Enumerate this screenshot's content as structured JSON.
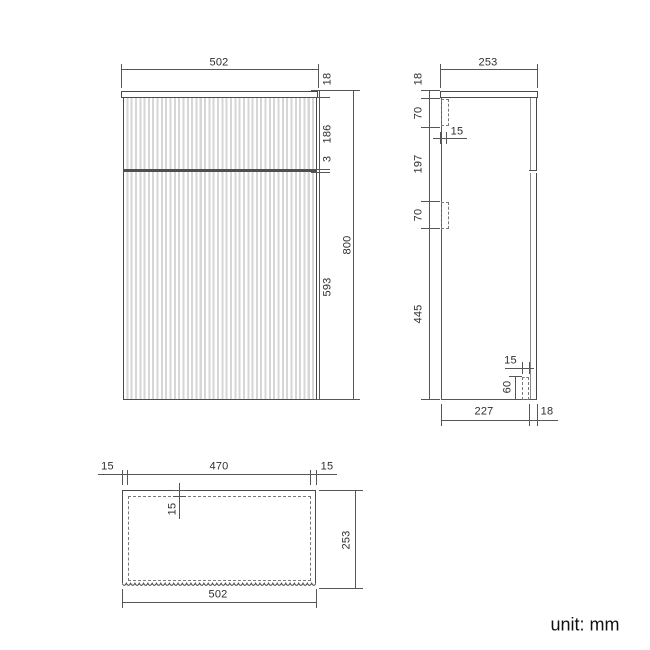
{
  "drawing": {
    "front_view": {
      "width": "502",
      "top_thickness": "18",
      "drawer_front_height": "186",
      "panel_gap": "3",
      "overall_height": "800",
      "lower_front_height": "593"
    },
    "side_view": {
      "depth": "253",
      "top_thickness": "18",
      "upper_bracket_height": "70",
      "bracket_thickness": "15",
      "bracket_spacing": "197",
      "middle_bracket_height": "70",
      "lower_section_height": "445",
      "bottom_bracket_thickness": "15",
      "bottom_bracket_height": "60",
      "base_depth": "227",
      "front_panel_thickness": "18"
    },
    "plan_view": {
      "left_overhang": "15",
      "inner_width": "470",
      "right_overhang": "15",
      "front_panel_thickness": "15",
      "depth": "253",
      "overall_width": "502"
    },
    "unit_note": "unit: mm"
  }
}
